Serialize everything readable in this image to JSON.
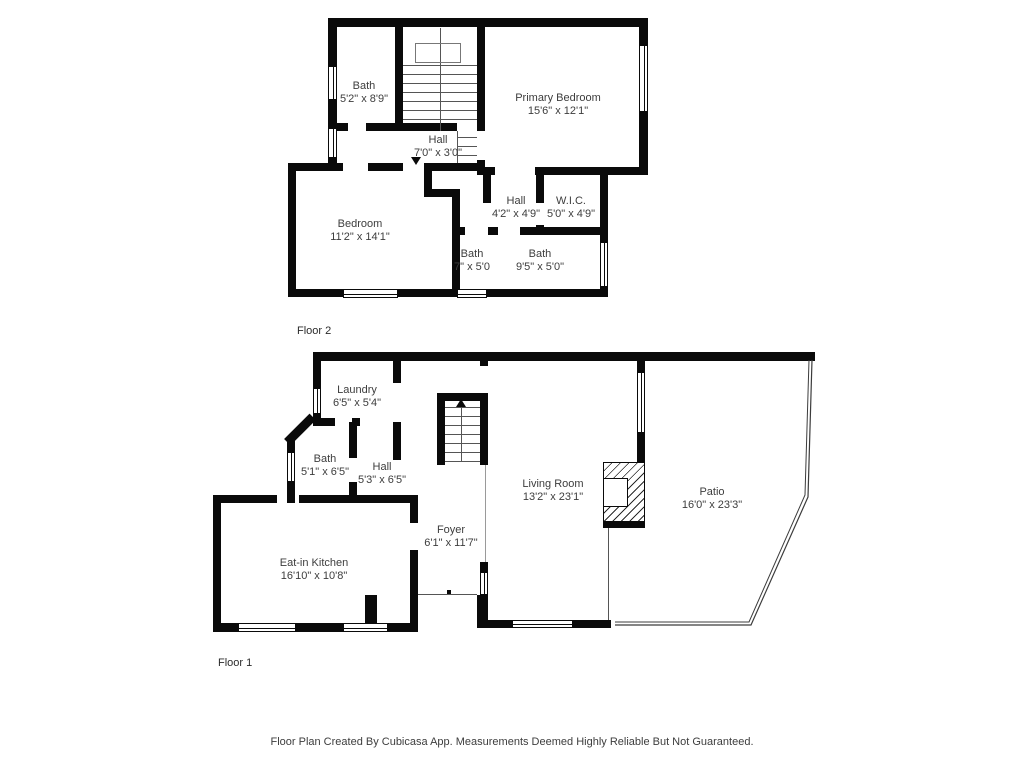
{
  "document": {
    "type": "floor-plan",
    "creator_note": "Floor Plan Created By Cubicasa App. Measurements Deemed Highly Reliable But Not Guaranteed."
  },
  "colors": {
    "wall": "#0a0a0a",
    "label_text": "#3d3d3d",
    "background": "#ffffff"
  },
  "floor2": {
    "label": "Floor 2",
    "rooms": [
      {
        "name": "Bath",
        "dims": "5'2\" x 8'9\""
      },
      {
        "name": "Hall",
        "dims": "7'0\" x 3'0\""
      },
      {
        "name": "Primary Bedroom",
        "dims": "15'6\" x 12'1\""
      },
      {
        "name": "Bedroom",
        "dims": "11'2\" x 14'1\""
      },
      {
        "name": "Hall",
        "dims": "4'2\" x 4'9\""
      },
      {
        "name": "W.I.C.",
        "dims": "5'0\" x 4'9\""
      },
      {
        "name": "Bath",
        "dims": "7\" x 5'0"
      },
      {
        "name": "Bath",
        "dims": "9'5\" x 5'0\""
      }
    ]
  },
  "floor1": {
    "label": "Floor 1",
    "rooms": [
      {
        "name": "Laundry",
        "dims": "6'5\" x 5'4\""
      },
      {
        "name": "Bath",
        "dims": "5'1\" x 6'5\""
      },
      {
        "name": "Hall",
        "dims": "5'3\" x 6'5\""
      },
      {
        "name": "Living Room",
        "dims": "13'2\" x 23'1\""
      },
      {
        "name": "Patio",
        "dims": "16'0\" x 23'3\""
      },
      {
        "name": "Eat-in Kitchen",
        "dims": "16'10\" x 10'8\""
      },
      {
        "name": "Foyer",
        "dims": "6'1\" x 11'7\""
      }
    ]
  }
}
